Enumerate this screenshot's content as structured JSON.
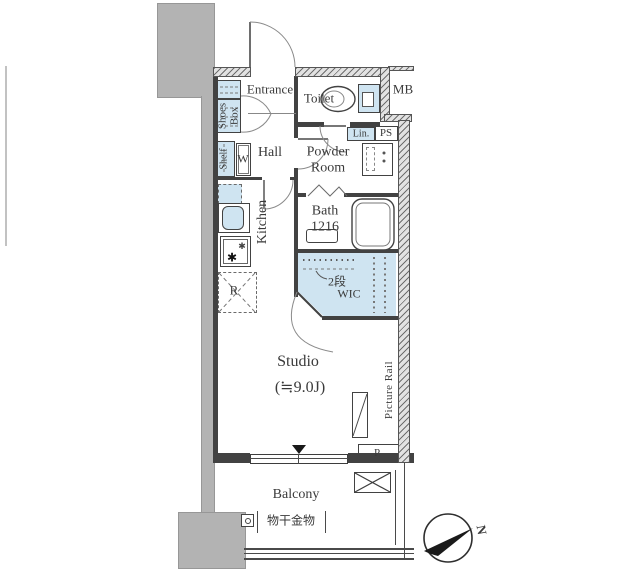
{
  "plan_title": "studio-apartment-floor-plan",
  "rooms": {
    "entrance": {
      "label": "Entrance"
    },
    "toilet": {
      "label": "Toilet"
    },
    "hall": {
      "label": "Hall"
    },
    "powder_room": {
      "line1": "Powder",
      "line2": "Room"
    },
    "bath": {
      "line1": "Bath",
      "line2": "1216"
    },
    "kitchen": {
      "label": "Kitchen"
    },
    "wic": {
      "tier": "2段",
      "label": "WIC"
    },
    "studio": {
      "label": "Studio",
      "size": "(≒9.0J)"
    },
    "balcony": {
      "label": "Balcony"
    }
  },
  "fixtures": {
    "shoes_box": {
      "line1": "Shoes",
      "line2": "Box"
    },
    "shelf": {
      "label": "Shelf"
    },
    "washing_machine": {
      "label": "W"
    },
    "refrigerator": {
      "label": "R"
    },
    "meter_box": {
      "label": "MB"
    },
    "pipe_space": {
      "label": "PS"
    },
    "linen": {
      "label": "Lin."
    },
    "picture_rail": {
      "label": "Picture Rail"
    },
    "pipe": {
      "label": "P"
    },
    "laundry_hardware": {
      "label": "物干金物"
    },
    "stove_burner": {
      "glyph1": "✱",
      "glyph2": "✱"
    }
  },
  "compass": {
    "north_label": "N"
  },
  "colors": {
    "fixture_fill": "#cfe4f1",
    "wall": "#424242",
    "concrete": "#b3b3b3",
    "arc": "#8a8a8a"
  }
}
